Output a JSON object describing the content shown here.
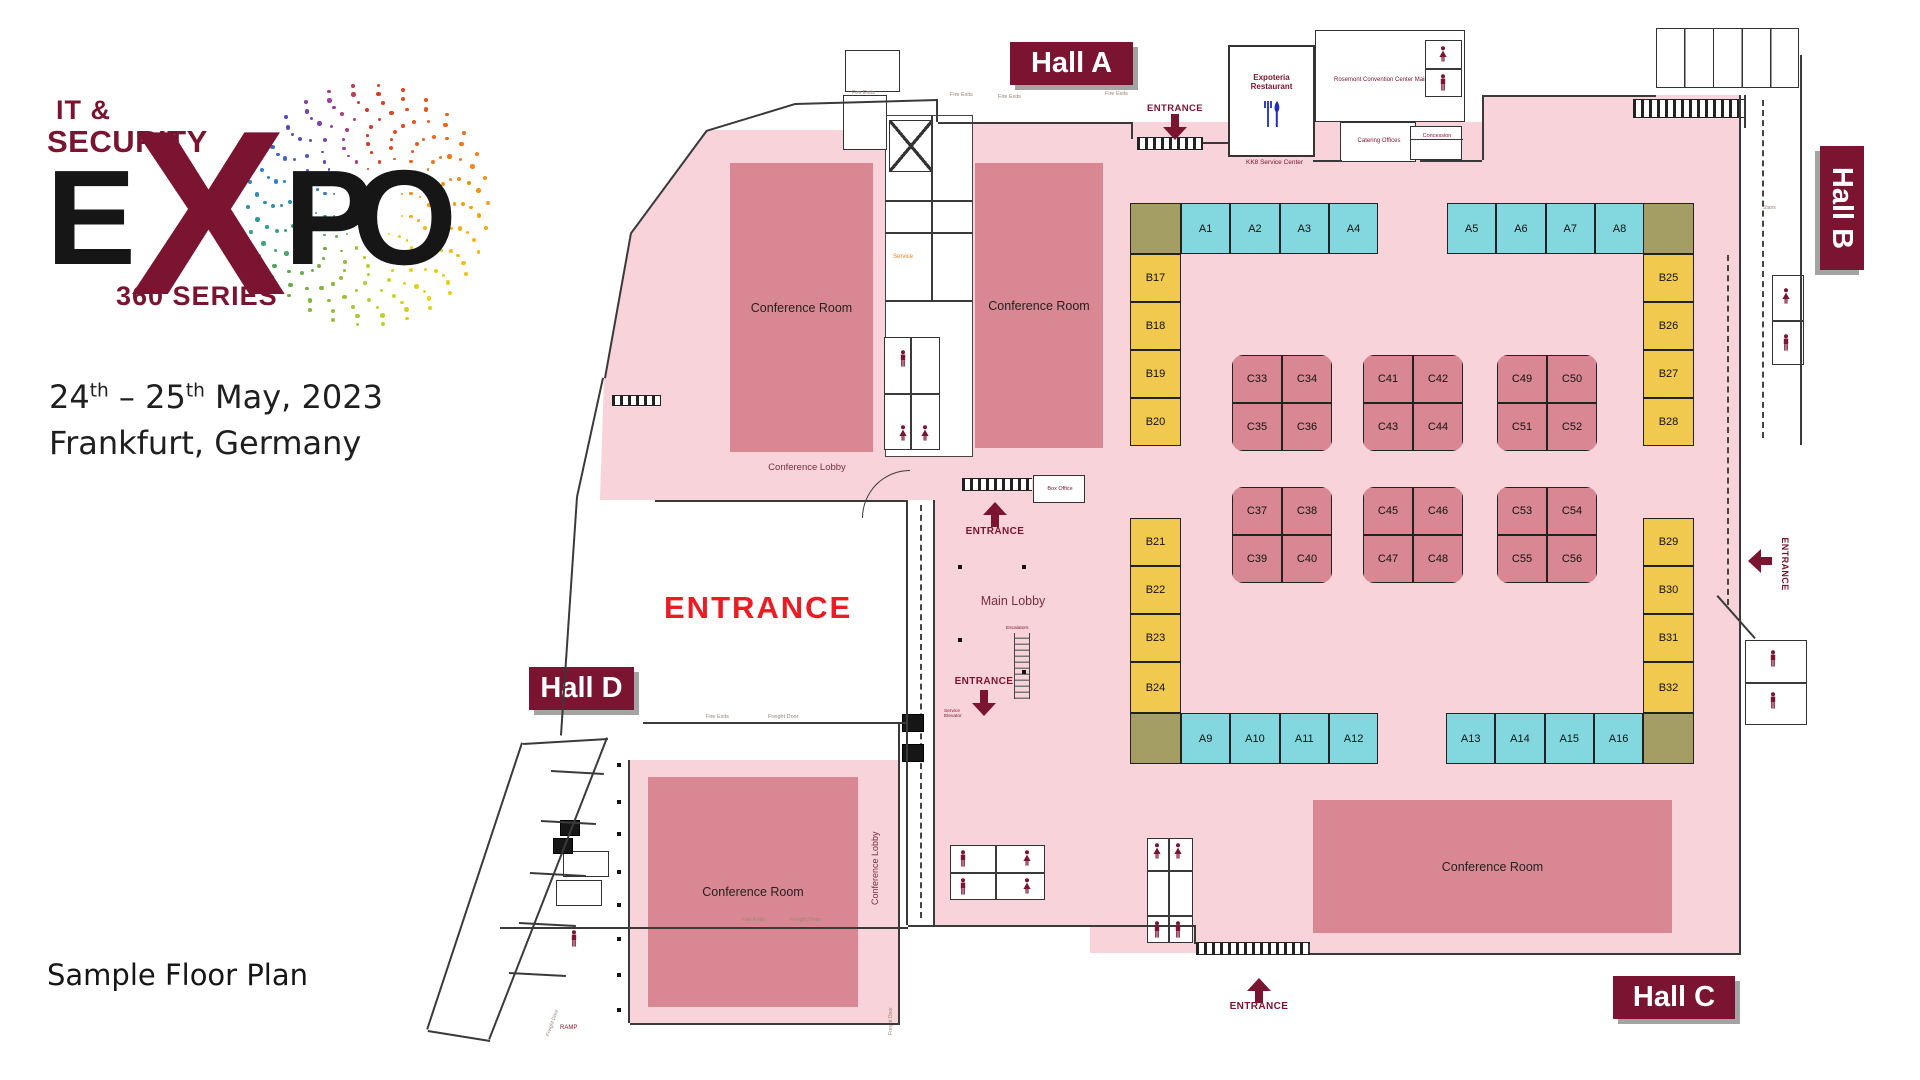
{
  "branding": {
    "logo_line1": "IT &",
    "logo_line2": "SECURITY",
    "logo_e": "E",
    "logo_x": "X",
    "logo_p": "P",
    "logo_o": "O",
    "logo_series": "360 SERIES",
    "date_day1": "24",
    "date_day2": "25",
    "date_sup": "th",
    "date_sep": "–",
    "date_rest": "May, 2023",
    "location": "Frankfurt, Germany",
    "caption": "Sample Floor Plan"
  },
  "labels": {
    "entrance_main": "ENTRANCE",
    "entrance": "ENTRANCE",
    "conference_room": "Conference Room",
    "conference_lobby": "Conference Lobby",
    "main_lobby": "Main Lobby",
    "restaurant_1": "Expoteria",
    "restaurant_2": "Restaurant",
    "offices": "Rosemont Convention Center Main Offices",
    "catering": "Catering Offices",
    "concession": "Concession",
    "service_center": "KK8 Service Center",
    "box_office": "Box Office",
    "escalators": "Escalators",
    "service_elevator": "Service Elevator",
    "service": "Service",
    "fire_exits": "Fire Exits",
    "freight_door": "Freight Door",
    "ramp": "RAMP",
    "stairs": "Stairs"
  },
  "halls": {
    "a": "Hall A",
    "b": "Hall B",
    "c": "Hall C",
    "d": "Hall D"
  },
  "booths": {
    "a_top_left": [
      "A1",
      "A2",
      "A3",
      "A4"
    ],
    "a_top_right": [
      "A5",
      "A6",
      "A7",
      "A8"
    ],
    "a_bottom_left": [
      "A9",
      "A10",
      "A11",
      "A12"
    ],
    "a_bottom_right": [
      "A13",
      "A14",
      "A15",
      "A16"
    ],
    "b_left_upper": [
      "B17",
      "B18",
      "B19",
      "B20"
    ],
    "b_left_lower": [
      "B21",
      "B22",
      "B23",
      "B24"
    ],
    "b_right_upper": [
      "B25",
      "B26",
      "B27",
      "B28"
    ],
    "b_right_lower": [
      "B29",
      "B30",
      "B31",
      "B32"
    ],
    "c_groups": [
      {
        "rows": [
          [
            "C33",
            "C34"
          ],
          [
            "C35",
            "C36"
          ]
        ]
      },
      {
        "rows": [
          [
            "C41",
            "C42"
          ],
          [
            "C43",
            "C44"
          ]
        ]
      },
      {
        "rows": [
          [
            "C49",
            "C50"
          ],
          [
            "C51",
            "C52"
          ]
        ]
      },
      {
        "rows": [
          [
            "C37",
            "C38"
          ],
          [
            "C39",
            "C40"
          ]
        ]
      },
      {
        "rows": [
          [
            "C45",
            "C46"
          ],
          [
            "C47",
            "C48"
          ]
        ]
      },
      {
        "rows": [
          [
            "C53",
            "C54"
          ],
          [
            "C55",
            "C56"
          ]
        ]
      }
    ]
  },
  "colors": {
    "maroon": "#7a1430",
    "red": "#ec1c24",
    "pink": "#f9d3da",
    "mauve": "#d98893",
    "teal": "#82d8de",
    "yellow": "#f0c94e",
    "olive": "#a49d64",
    "blue": "#2329c4",
    "orange": "#e8821e"
  }
}
